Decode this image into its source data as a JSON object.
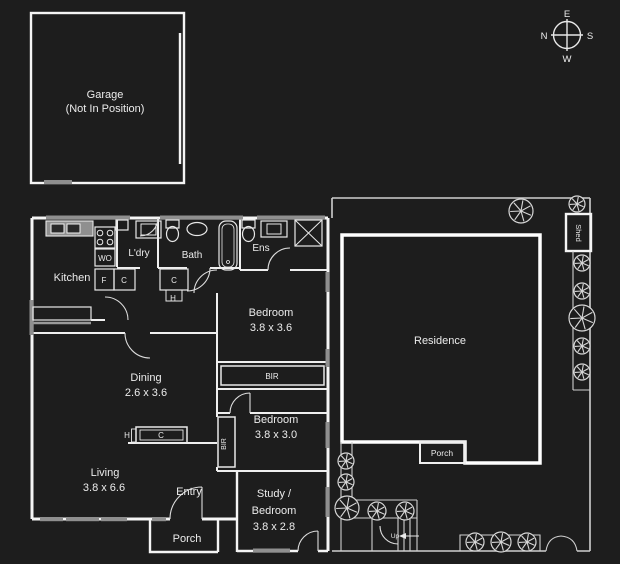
{
  "colors": {
    "background": "#1d1d1d",
    "wall": "#ffffff",
    "window_gray": "#8f8f8f",
    "text": "#ececec"
  },
  "compass": {
    "n": "N",
    "e": "E",
    "s": "S",
    "w": "W"
  },
  "garage": {
    "title": "Garage",
    "subtitle": "(Not In Position)"
  },
  "house": {
    "kitchen": "Kitchen",
    "laundry": "L'dry",
    "bath": "Bath",
    "ens": "Ens",
    "bedroom1": {
      "name": "Bedroom",
      "dims": "3.8 x 3.6"
    },
    "bedroom2": {
      "name": "Bedroom",
      "dims": "3.8 x 3.0"
    },
    "dining": {
      "name": "Dining",
      "dims": "2.6 x 3.6"
    },
    "living": {
      "name": "Living",
      "dims": "3.8 x 6.6"
    },
    "study": {
      "line1": "Study /",
      "line2": "Bedroom",
      "dims": "3.8 x 2.8"
    },
    "entry": "Entry",
    "porch": "Porch",
    "bir": "BIR",
    "fixtures": {
      "wall_oven": "WO",
      "fridge": "F",
      "cupboard": "C",
      "h": "H"
    }
  },
  "site": {
    "residence": "Residence",
    "shed": "Shed",
    "porch": "Porch",
    "up": "Up"
  }
}
